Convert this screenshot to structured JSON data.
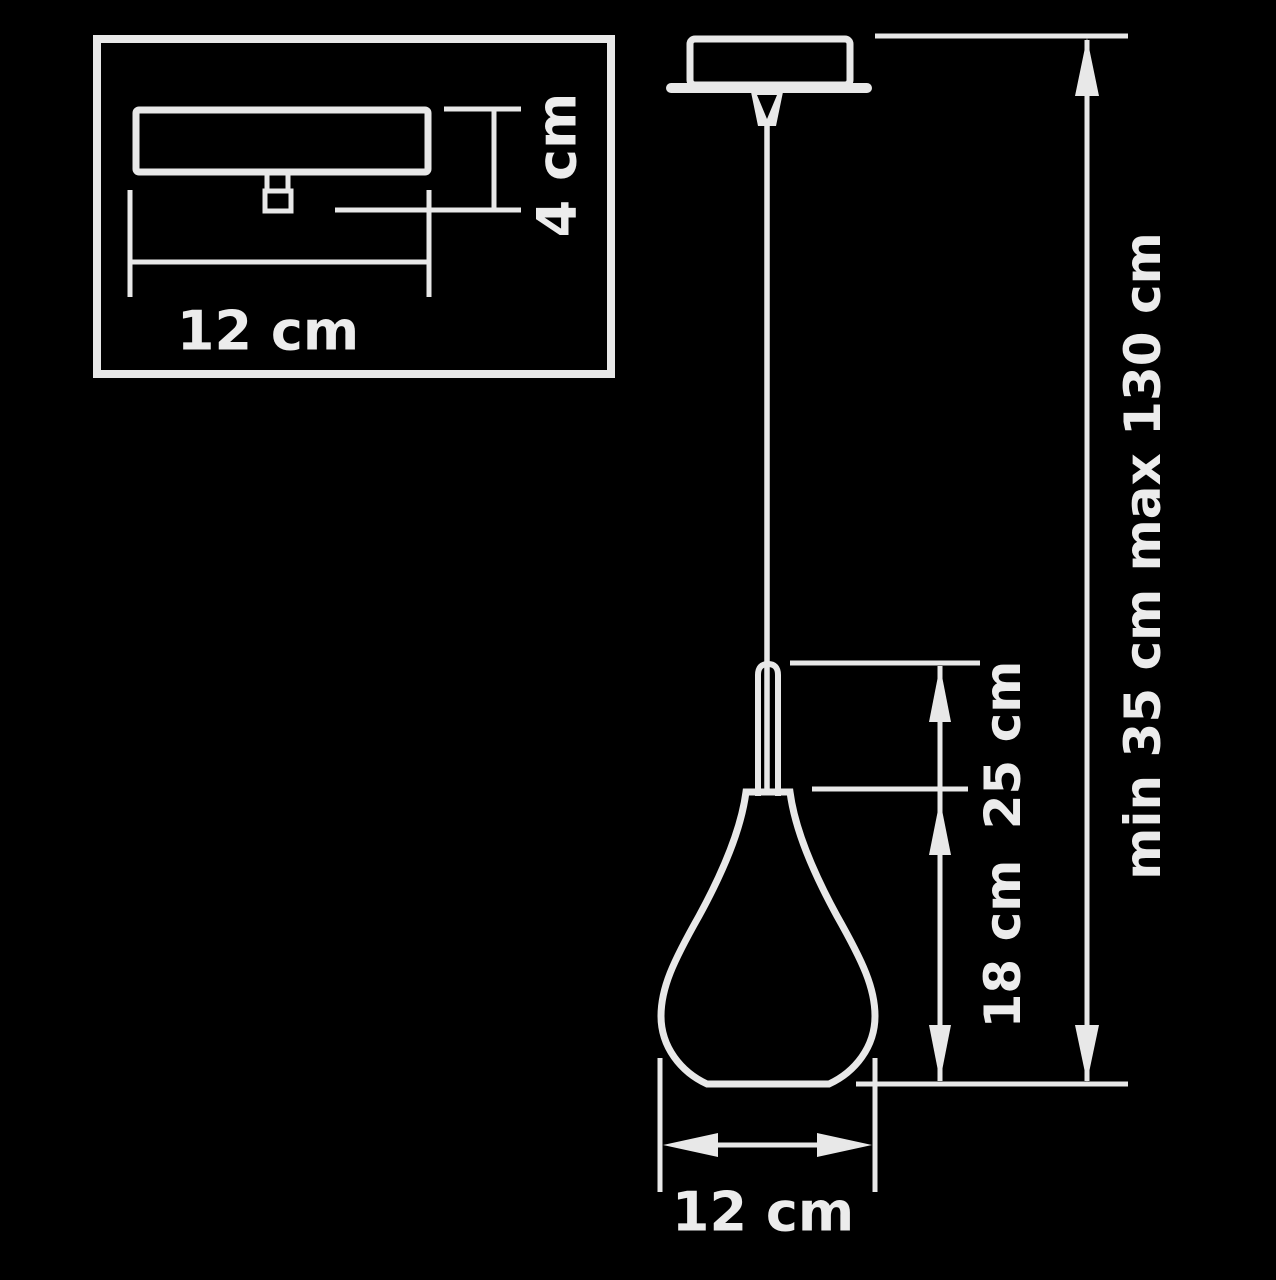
{
  "diagram": {
    "type": "technical-dimension-drawing",
    "subject": "pendant-lamp",
    "colors": {
      "background": "#000000",
      "line": "#e8e8e8",
      "text": "#ececec"
    },
    "inset": {
      "width_label": "12 cm",
      "height_label": "4 cm"
    },
    "main": {
      "body_height_label": "25 cm",
      "shade_height_label": "18 cm",
      "suspension_label": "min 35 cm max 130 cm",
      "shade_width_label": "12 cm"
    }
  }
}
